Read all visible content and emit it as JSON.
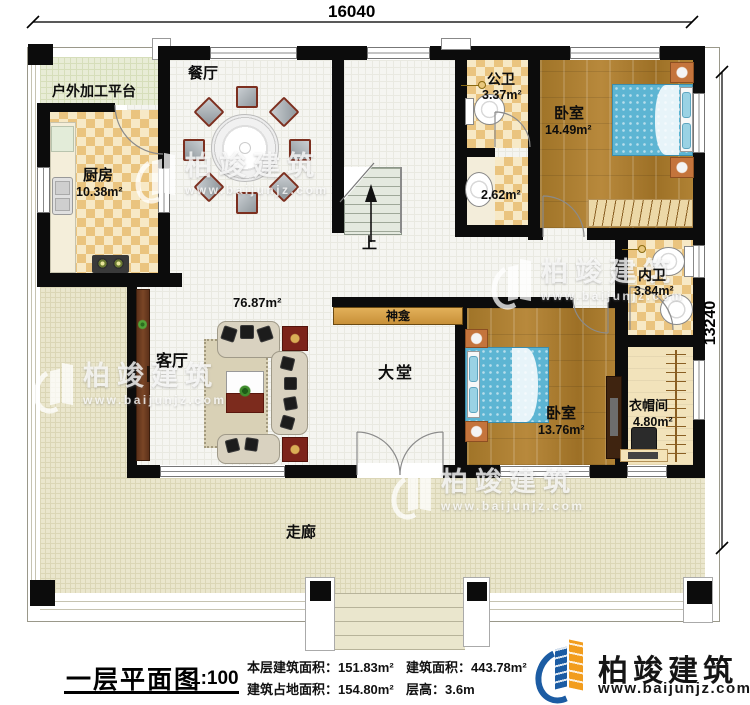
{
  "dimensions": {
    "top": "16040",
    "right": "13240"
  },
  "rooms": [
    {
      "label": "户外加工平台",
      "area": ""
    },
    {
      "label": "厨房",
      "area": "10.38m²"
    },
    {
      "label": "餐厅",
      "area": ""
    },
    {
      "label": "公卫",
      "area": "3.37m²"
    },
    {
      "label": "",
      "area": "2.62m²"
    },
    {
      "label": "卧室",
      "area": "14.49m²"
    },
    {
      "label": "内卫",
      "area": "3.84m²"
    },
    {
      "label": "神龛",
      "area": ""
    },
    {
      "label": "大堂",
      "area": ""
    },
    {
      "label": "客厅",
      "area": "76.87m²"
    },
    {
      "label": "卧室",
      "area": "13.76m²"
    },
    {
      "label": "衣帽间",
      "area": "4.80m²"
    },
    {
      "label": "走廊",
      "area": ""
    },
    {
      "label": "上",
      "area": ""
    }
  ],
  "title_block": {
    "title": "一层平面图",
    "scale": "1:100",
    "stats": [
      {
        "label": "本层建筑面积：",
        "value": "151.83m²"
      },
      {
        "label": "建筑占地面积：",
        "value": "154.80m²"
      },
      {
        "label": "建筑面积：",
        "value": "443.78m²"
      },
      {
        "label": "层高：",
        "value": "3.6m"
      }
    ]
  },
  "logo": {
    "name": "柏竣建筑",
    "url": "www.baijunjz.com",
    "icon": "building-logo-icon"
  },
  "watermark": {
    "name": "柏竣建筑",
    "url": "www.baijunjz.com",
    "icon": "building-logo-icon"
  },
  "colors": {
    "wall": "#0c0c0c",
    "wood": "#a57b2f",
    "bed_blue": "#5db5d3",
    "corridor": "#eae6cd",
    "checker": "#eac47f",
    "logo_blue": "#1c5ca3",
    "logo_orange": "#f29d1e"
  }
}
